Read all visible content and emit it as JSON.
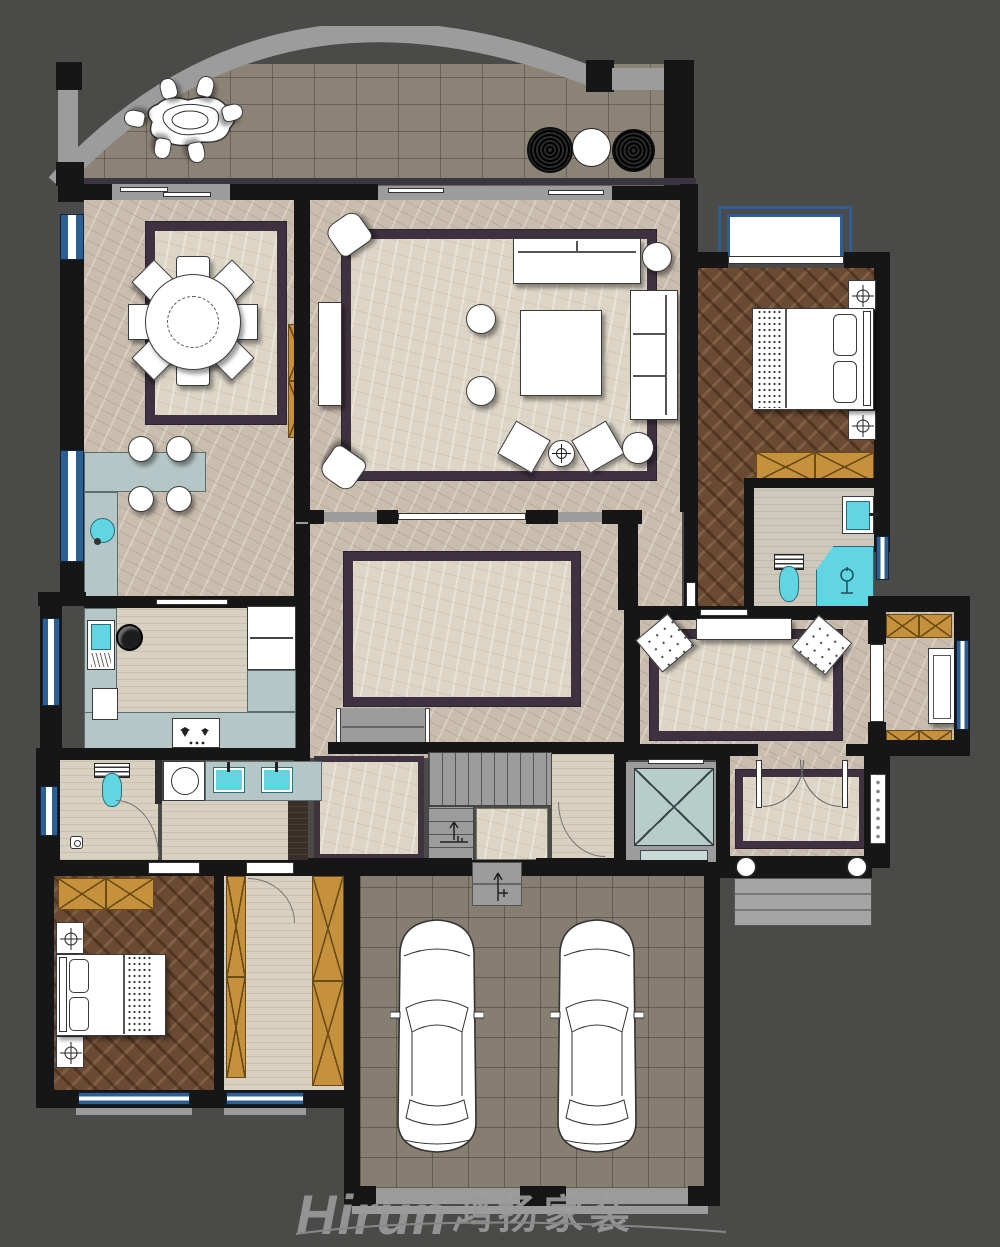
{
  "logo": {
    "brand": "Hirun",
    "cjk": "鸿扬家装"
  },
  "palette": {
    "bg": "#4a4a48",
    "wall": "#161616",
    "pier": "#9c9c9c",
    "mbeige": "#c9bdae",
    "mlight": "#ddd6c6",
    "rug": "#3f3240",
    "wood": "#6b4a33",
    "trav": "#d8d0c0",
    "stone": "#8b8376",
    "gtile": "#867e70",
    "counter": "#b5c6c6",
    "tan": "#c6913c",
    "elev": "#b7cdc9",
    "win": "#2e5f94",
    "cyan": "#62d5e2",
    "logo": "#9a9a9a"
  },
  "plan": {
    "type": "residential-floor-plan",
    "rooms": [
      {
        "name": "terrace",
        "furniture": [
          "outdoor-dining-table",
          "outdoor-chairs-x6",
          "planters-x3",
          "arched-parapet"
        ]
      },
      {
        "name": "dining-room",
        "furniture": [
          "round-dining-table",
          "dining-chairs-x8",
          "area-rug",
          "bar-counter",
          "bar-stools-x4",
          "bar-sink",
          "tall-cabinet"
        ]
      },
      {
        "name": "living-room",
        "furniture": [
          "sofa",
          "side-sofa",
          "coffee-table",
          "ottomans-x2",
          "armchairs-x4",
          "console-table",
          "side-tables-x2",
          "area-rug"
        ]
      },
      {
        "name": "kitchen",
        "furniture": [
          "u-shaped-counter",
          "sink",
          "cooktop",
          "refrigerator",
          "sliding-door"
        ]
      },
      {
        "name": "family-hall",
        "furniture": [
          "marble-inlay-rug",
          "staircase",
          "elevator"
        ]
      },
      {
        "name": "master-bedroom",
        "furniture": [
          "double-bed",
          "nightstands-x2",
          "wardrobe",
          "bay-window"
        ]
      },
      {
        "name": "master-bathroom",
        "furniture": [
          "toilet",
          "washbasin",
          "shower"
        ]
      },
      {
        "name": "study",
        "furniture": [
          "console-table",
          "tufted-armchairs-x2",
          "area-rug"
        ]
      },
      {
        "name": "balcony",
        "furniture": [
          "bench",
          "storage-cabinets-x2"
        ]
      },
      {
        "name": "foyer",
        "furniture": [
          "double-entry-door",
          "round-columns-x2",
          "entry-steps",
          "shoe-cabinet",
          "area-rug"
        ]
      },
      {
        "name": "guest-bathroom-laundry",
        "furniture": [
          "toilet",
          "floor-drain",
          "washing-machine",
          "double-vanity"
        ]
      },
      {
        "name": "second-bedroom",
        "furniture": [
          "double-bed",
          "nightstands-x2",
          "wardrobe"
        ]
      },
      {
        "name": "walk-in-closet",
        "furniture": [
          "wardrobes-x2"
        ]
      },
      {
        "name": "garage",
        "furniture": [
          "car-x2",
          "entry-step"
        ]
      }
    ]
  }
}
